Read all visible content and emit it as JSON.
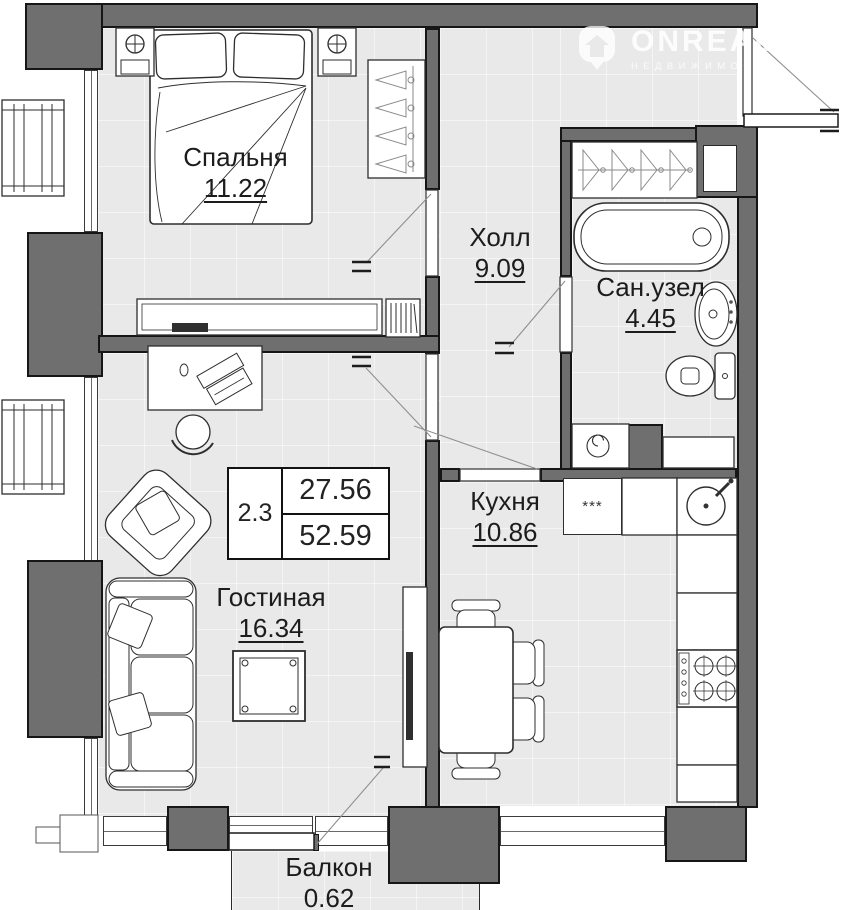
{
  "watermark": {
    "brand": "ONREALT",
    "tagline": "НЕДВИЖИМОСТЬ"
  },
  "rooms": {
    "bedroom": {
      "name": "Спальня",
      "area": "11.22"
    },
    "hall": {
      "name": "Холл",
      "area": "9.09"
    },
    "bathroom": {
      "name": "Сан.узел",
      "area": "4.45"
    },
    "kitchen": {
      "name": "Кухня",
      "area": "10.86"
    },
    "living": {
      "name": "Гостиная",
      "area": "16.34"
    },
    "balcony": {
      "name": "Балкон",
      "area": "0.62"
    }
  },
  "stats": {
    "unit_code": "2.3",
    "living_area": "27.56",
    "total_area": "52.59"
  },
  "symbols": {
    "fridge": "***"
  },
  "colors": {
    "wall": "#6f6f6f",
    "outline": "#161616",
    "floor": "#e9e9e9"
  }
}
